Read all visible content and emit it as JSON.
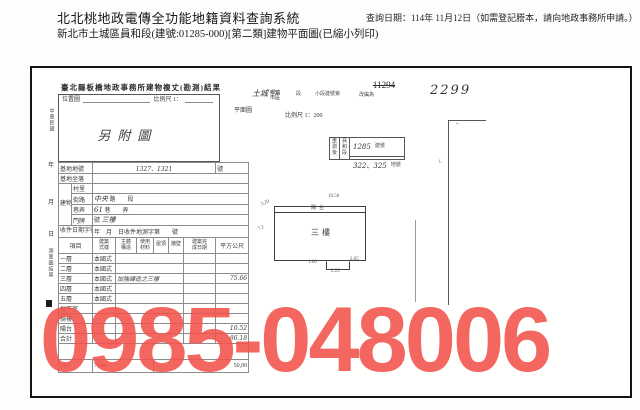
{
  "header": {
    "system_title": "北北桃地政電傳全功能地籍資料查詢系統",
    "subtitle": "新北市土城區員和段(建號:01285-000)[第二類]建物平面圖(已縮小列印)",
    "query_date": "查詢日期：114年 11月12日（如需登記謄本，請向地政事務所申請。）"
  },
  "watermark": {
    "text": "0985-048006",
    "color": "#f2534b"
  },
  "form": {
    "title": "臺北縣板橋地政事務所建物複丈(勘測)結果",
    "plan_section_label": "平面圖",
    "location_box": {
      "label": "位置圖",
      "scale_label": "比例尺 1：",
      "content": "另附圖"
    },
    "margin": {
      "era": "中華民國",
      "year": "年",
      "month": "月",
      "day": "日",
      "result_note": "測量圖結果"
    },
    "site_row": {
      "label": "基地地號",
      "value": "1327、1321",
      "unit": "號"
    },
    "seat_row": {
      "label": "基地坐落"
    },
    "door": {
      "group": "建物門牌",
      "village_label": "村里",
      "street_label": "街路",
      "street_value": "中央",
      "street_unit": "路　　段",
      "lane_label": "巷弄",
      "lane_value": "61",
      "lane_unit": "巷　　弄",
      "no_label": "門牌",
      "no_unit": "號",
      "no_value": "三樓"
    },
    "receipt_row": {
      "label": "收件日期字號",
      "text": "年　月　日收件地測字第　　號"
    },
    "floor_table": {
      "headers": [
        "項目",
        "建築式樣",
        "主體構造",
        "使用材料",
        "屋頂",
        "牆壁",
        "建築完成日期",
        "平方公尺"
      ],
      "rows": [
        {
          "label": "一層",
          "style": "本國式",
          "note": "",
          "value": ""
        },
        {
          "label": "二層",
          "style": "本國式",
          "note": "",
          "value": ""
        },
        {
          "label": "三層",
          "style": "本國式",
          "note": "加強磚造之三樓",
          "value": "75.66"
        },
        {
          "label": "四層",
          "style": "本國式",
          "note": "",
          "value": ""
        },
        {
          "label": "五層",
          "style": "本國式",
          "note": "",
          "value": ""
        },
        {
          "label": "地下室",
          "style": "",
          "note": "",
          "value": ""
        },
        {
          "label": "騎樓",
          "style": "",
          "note": "",
          "value": ""
        },
        {
          "label": "陽台",
          "style": "",
          "note": "",
          "value": "10.52"
        },
        {
          "label": "合計",
          "style": "",
          "note": "",
          "value": "86.18"
        }
      ],
      "footer_left": "210",
      "footer_mid": "7mm",
      "footer_right": "50,00"
    }
  },
  "plan": {
    "old_number": "11294",
    "city_value": "土城",
    "district_label": "鄉鎮市區",
    "section_label": "段",
    "subsection_label": "小段建號第",
    "renumber_label": "改編為",
    "new_number": "2299",
    "scale": "比例尺 1：200",
    "resurvey_box": {
      "col1": "重測後",
      "col2": "員和段",
      "building_no": "1285",
      "building_no_unit": "建號",
      "lot_no": "322、325",
      "lot_no_unit": "地號"
    },
    "building": {
      "floor_label": "三樓",
      "balcony_label": "陽台",
      "dim_top": "10.56",
      "dim_left_a": "3.20",
      "dim_left_b": "7.2",
      "dim_notch_left": "1.06",
      "dim_notch_bottom": "2.25",
      "dim_notch_right": "2.65"
    }
  }
}
